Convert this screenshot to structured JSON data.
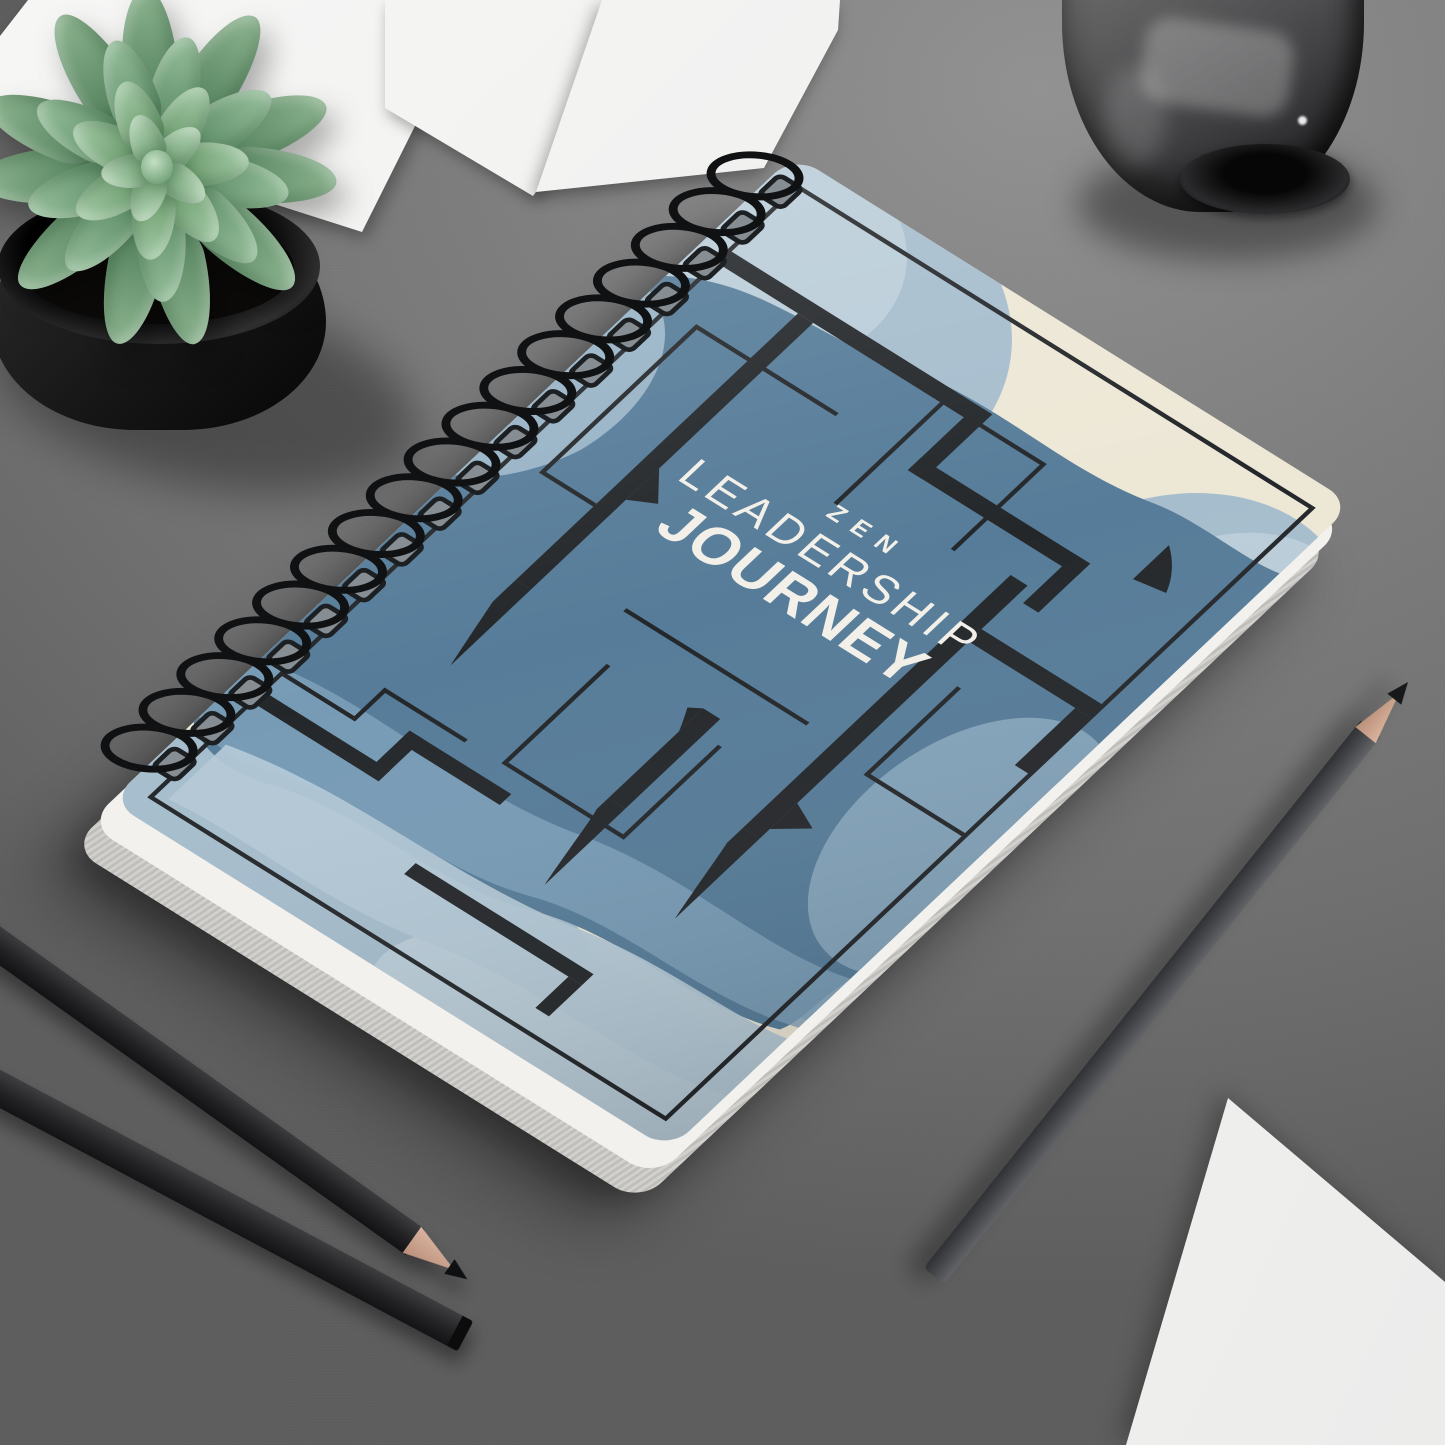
{
  "scene": {
    "type": "product-mockup-photo",
    "surface": "gray textured desk",
    "desk_color": "#7d7d7d"
  },
  "notebook": {
    "product": "spiral-bound notebook",
    "title_line1": "ZEN",
    "title_line2": "LEADERSHIP",
    "title_line3": "JOURNEY",
    "coil_count": 17,
    "colors": {
      "cover_blue": "#567C99",
      "cover_blue_light": "#A6BDCD",
      "cover_blue_lighter": "#BACDD9",
      "cover_cream": "#EDE7D6",
      "pattern_black": "#24272A",
      "title_text": "#F2F0E8",
      "coil_black": "#101113"
    }
  },
  "objects": {
    "plant": {
      "label": "succulent in black pot",
      "leaf_colors": [
        "#4f7d58",
        "#8cb48f",
        "#5a8a63",
        "#96bf9b",
        "#679768",
        "#a4cba7",
        "#74a477",
        "#b2d4b4"
      ]
    },
    "glass": {
      "label": "smoked glass tumbler"
    },
    "pencils": [
      {
        "label": "gray pencil sharpened"
      },
      {
        "label": "black pencil sharpened"
      },
      {
        "label": "black pencil unsharpened"
      }
    ],
    "papers": {
      "label": "white paper sheets",
      "count": 4
    }
  }
}
